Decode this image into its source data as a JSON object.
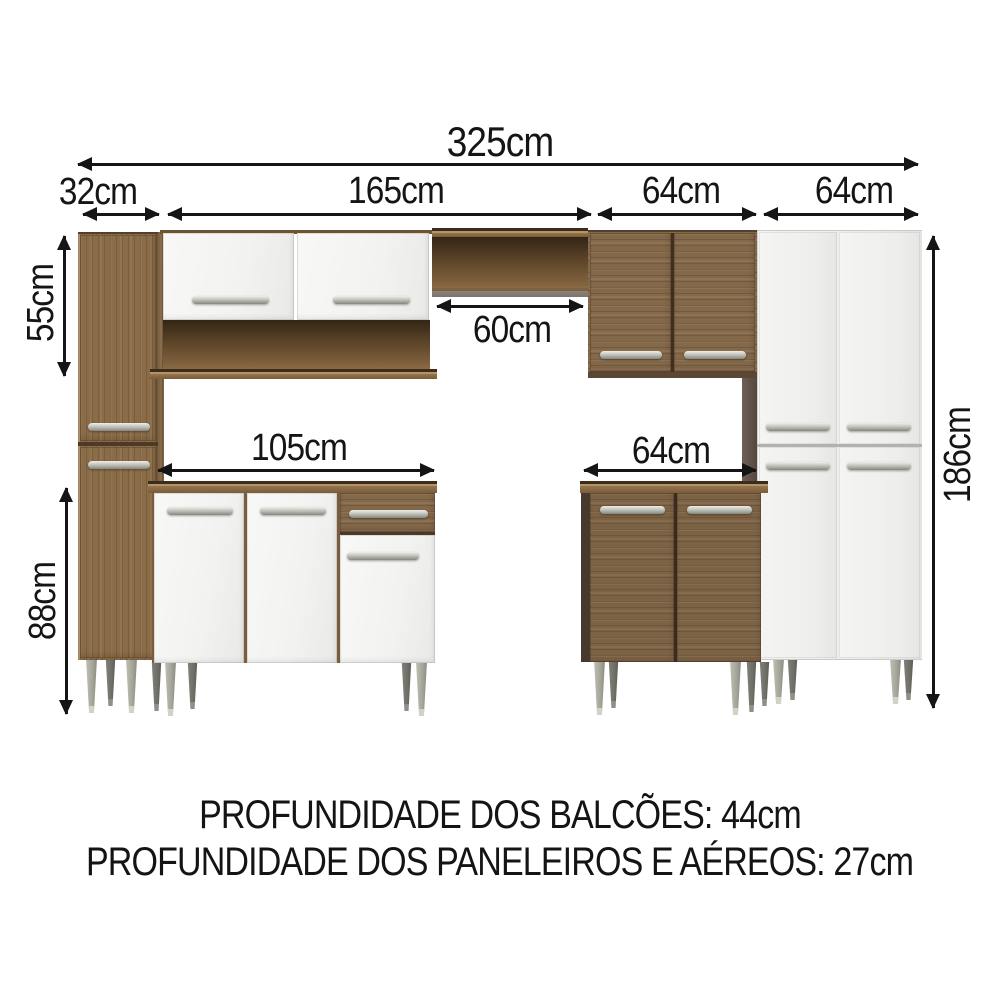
{
  "diagram_title": "kitchen-cabinet-set-dimensions",
  "dimensions": {
    "total_width": "325cm",
    "tall_left_cabinet_width": "32cm",
    "wall_section_width": "165cm",
    "wall_cabinet_wood_width": "64cm",
    "tall_white_cabinet_width": "64cm",
    "wall_cabinet_height": "55cm",
    "base_cabinet_height": "88cm",
    "open_niche_width": "60cm",
    "base_cabinet_left_width": "105cm",
    "base_cabinet_right_width": "64cm",
    "tall_cabinet_height": "186cm"
  },
  "footer": {
    "line1": "PROFUNDIDADE DOS BALCÕES: 44cm",
    "line2": "PROFUNDIDADE DOS PANELEIROS E AÉREOS: 27cm"
  },
  "colors": {
    "background": "#ffffff",
    "dimension_lines": "#151515",
    "wood": "#84684a",
    "wood_dark": "#5a4428",
    "white_door": "#f4f4f3",
    "handle_silver": "#b9bab2",
    "leg_gray": "#a5a599"
  }
}
